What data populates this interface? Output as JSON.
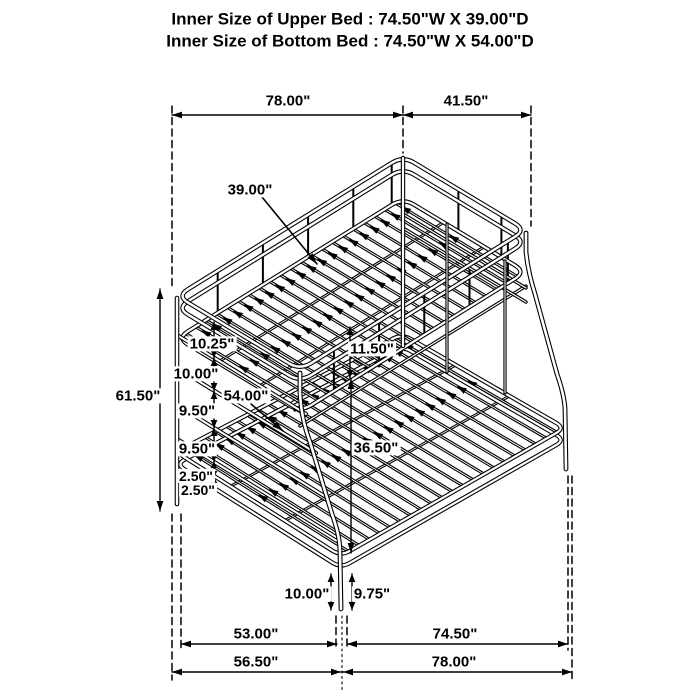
{
  "title": {
    "upper_bed": "Inner Size of Upper Bed : 74.50\"W X 39.00\"D",
    "bottom_bed": "Inner Size of Bottom Bed : 74.50\"W X 54.00\"D"
  },
  "dims": {
    "overall_length_top": "78.00\"",
    "overall_width_top": "41.50\"",
    "upper_inner_width": "39.00\"",
    "overall_height": "61.50\"",
    "rung_spacing_1": "10.25\"",
    "rung_spacing_2": "10.00\"",
    "rung_spacing_3": "9.50\"",
    "rung_spacing_4": "9.50\"",
    "frame_gap_1": "2.50\"",
    "frame_gap_2": "2.50\"",
    "guardrail_height": "11.50\"",
    "lower_inner_width": "54.00\"",
    "bunk_clearance": "36.50\"",
    "front_leg_height": "10.00\"",
    "rear_leg_height": "9.75\"",
    "bottom_inner_width": "53.00\"",
    "bottom_inner_length": "74.50\"",
    "bottom_overall_width": "56.50\"",
    "bottom_overall_length": "78.00\""
  },
  "colors": {
    "line": "#000000",
    "background": "#ffffff"
  }
}
